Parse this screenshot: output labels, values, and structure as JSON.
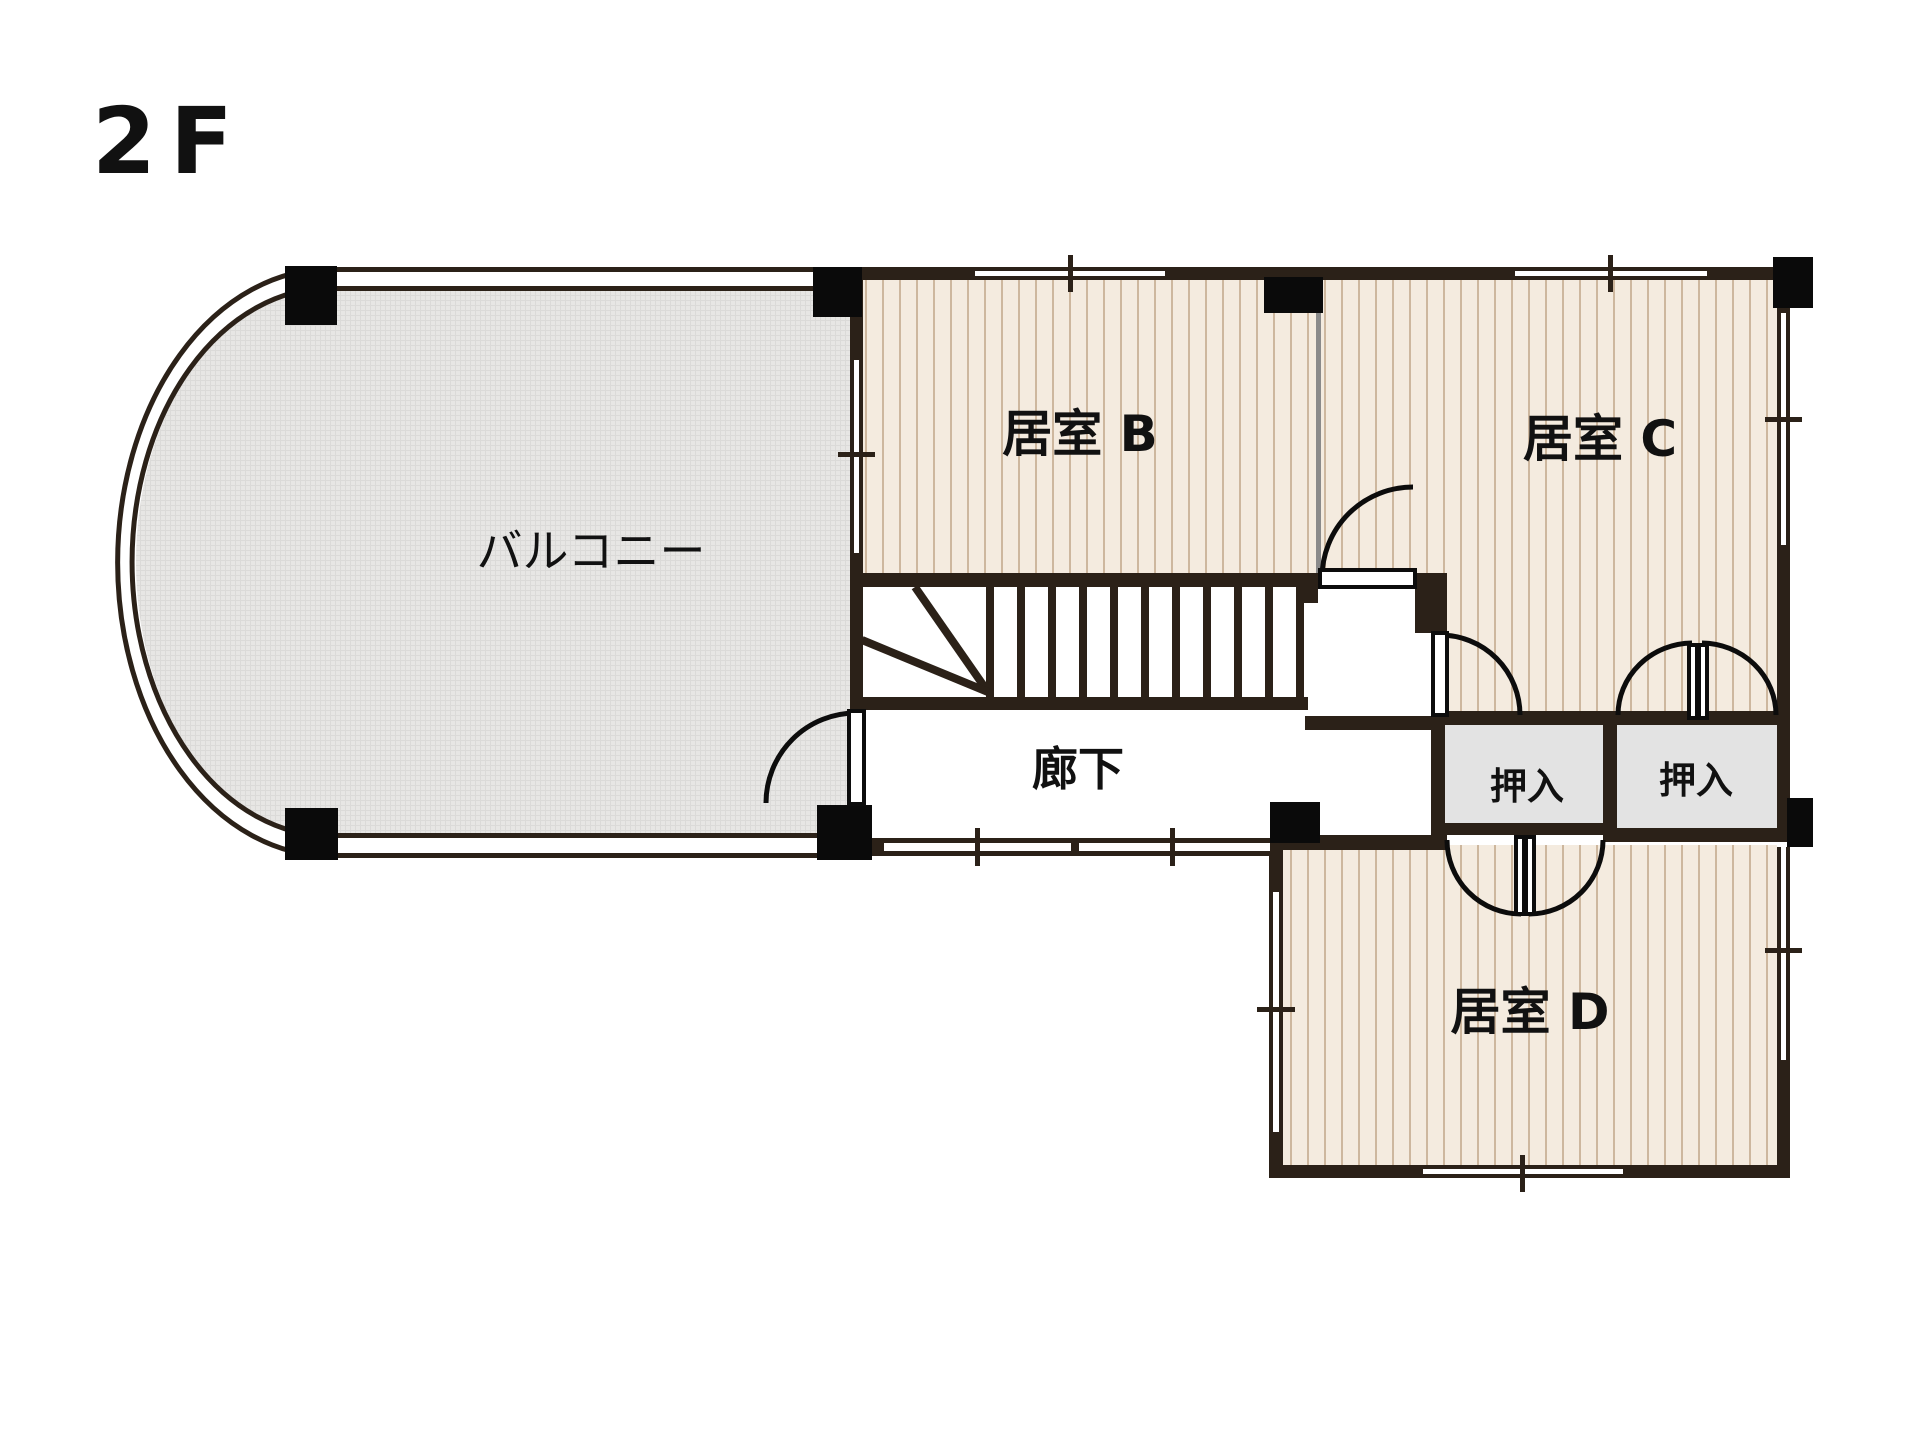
{
  "title": "2F floor plan",
  "floor_label": "2F",
  "rooms": {
    "balcony": {
      "label": "バルコニー"
    },
    "room_b": {
      "label": "居室 B"
    },
    "room_c": {
      "label": "居室 C"
    },
    "room_d": {
      "label": "居室 D"
    },
    "hallway": {
      "label": "廊下"
    },
    "closet_left": {
      "label": "押入"
    },
    "closet_right": {
      "label": "押入"
    }
  },
  "colors": {
    "wall": "#2b2118",
    "post": "#0a0a0a",
    "floor-bg": "#f4ebdf",
    "floor-stripe": "#cdb79e",
    "balcony-bg": "#e7e6e4",
    "balcony-grid": "#dbdad8",
    "closet-bg": "#e3e3e3",
    "partition": "#8a8a8a",
    "door-line": "#0c0c0c",
    "text": "#111111"
  }
}
